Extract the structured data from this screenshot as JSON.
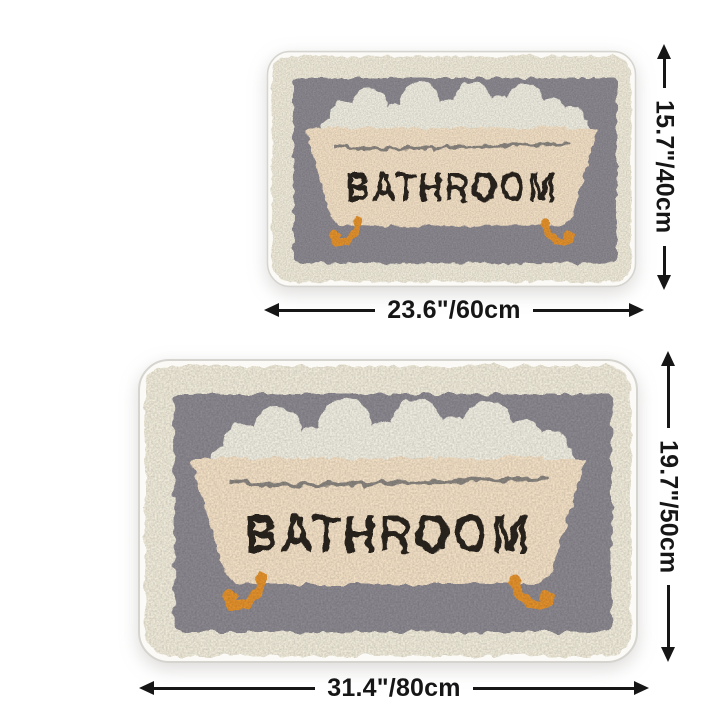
{
  "page": {
    "background_color": "#ffffff",
    "description_tub_text": "BATHROOM"
  },
  "artwork": {
    "tub_text": "BATHROOM",
    "colors": {
      "page_bg": "#ffffff",
      "mat_edge_fill": "#fbfaf6",
      "mat_edge_stroke": "#d6d4cf",
      "mat_border_cream": "#f3eedd",
      "mat_inner_gray": "#8e8a92",
      "foam_white": "#f2f0e3",
      "tub_cream": "#f6e3c8",
      "tub_rim_line": "#8b8680",
      "tub_text_dark": "#2a241e",
      "feet_orange": "#e6932c",
      "dimension_ink": "#161616"
    }
  },
  "mats": [
    {
      "size": "small",
      "width_label": "23.6\"/60cm",
      "height_label": "15.7\"/40cm"
    },
    {
      "size": "large",
      "width_label": "31.4\"/80cm",
      "height_label": "19.7\"/50cm"
    }
  ]
}
